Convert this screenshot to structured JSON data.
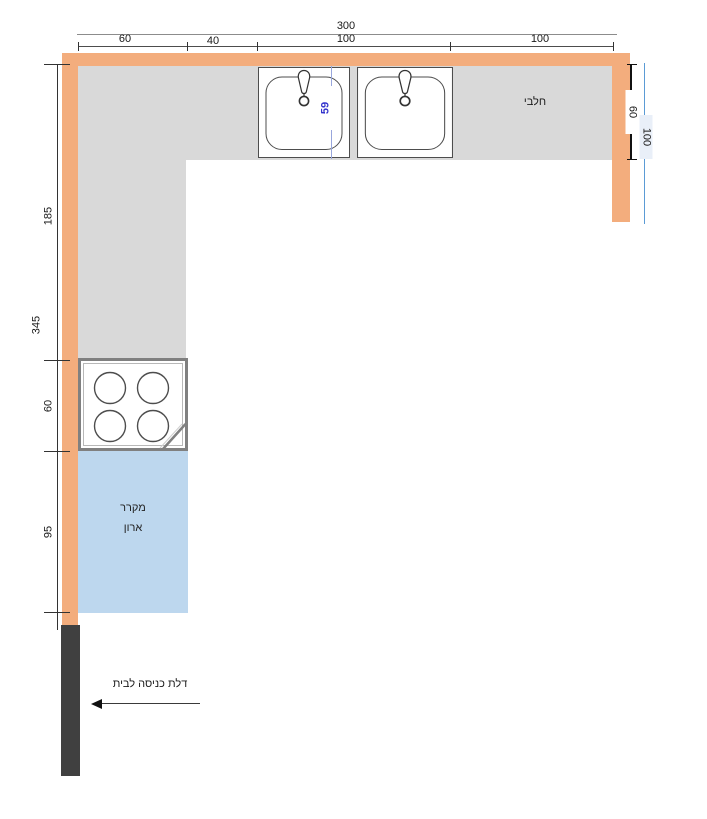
{
  "colors": {
    "wall": "#f3ad7d",
    "counter": "#d9d9d9",
    "fridge_area": "#bdd7ee",
    "door": "#404040",
    "right_dim_line": "#5b9bd5",
    "sink_dim_text": "#3333cc"
  },
  "dimensions_top": {
    "total": "300",
    "segments": [
      "60",
      "40",
      "100",
      "100"
    ]
  },
  "dimensions_left": {
    "total": "345",
    "segments": [
      "185",
      "60",
      "95"
    ]
  },
  "dimensions_right": {
    "counter_depth": "60",
    "wall_length": "100"
  },
  "sink": {
    "width_dim": "59"
  },
  "labels": {
    "dairy": "חלבי",
    "fridge_line1": "מקרר",
    "fridge_line2": "ארון",
    "entrance_door": "דלת כניסה לבית"
  }
}
